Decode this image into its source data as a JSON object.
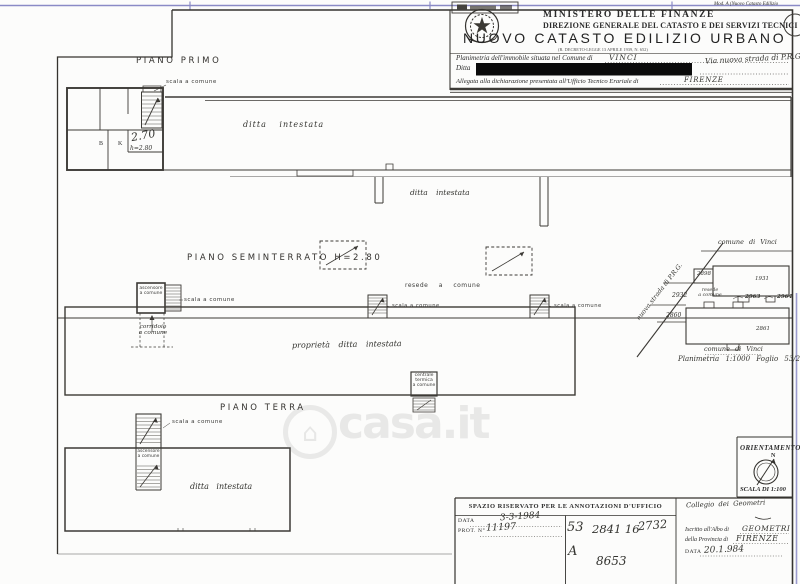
{
  "watermark": {
    "text": "casa.it"
  },
  "header": {
    "mod_label": "Mod. A (Nuovo Catasto Edilizio",
    "ministry": "MINISTERO DELLE FINANZE",
    "direzione": "DIREZIONE GENERALE DEL CATASTO E DEI SERVIZI TECNICI ERARIALI",
    "title": "NUOVO CATASTO EDILIZIO URBANO",
    "decree": "(R. DECRETO-LEGGE 13 APRILE 1939, N. 652)",
    "line1_label": "Planimetria dell'immobile situata nel Comune di",
    "line1_value": "VINCI",
    "line1_right": "Via nuova strada di P.R.G.",
    "ditta_label": "Ditta",
    "line3_label": "Allegata alla dichiarazione presentata all'Ufficio Tecnico Erariale di",
    "line3_value": "FIRENZE"
  },
  "piano_primo": {
    "title": "PIANO PRIMO",
    "scala_label": "scala a comune",
    "room_b": "B",
    "room_k": "K",
    "note_big": "2.70",
    "note_small": "h=2.80",
    "strip_label": "ditta intestata",
    "strip_label2": "ditta intestata"
  },
  "seminterrato": {
    "title": "PIANO SEMINTERRATO H=2.80",
    "ascensore": "ascensore\na comune",
    "scala1": "scala a comune",
    "corridoio": "corridoio\na comune",
    "resede": "resede  a  comune",
    "scala2": "scala a comune",
    "scala3": "scala a comune",
    "proprieta": "proprietà ditta intestata",
    "centrale": "centrale\ntermica\na comune"
  },
  "terra": {
    "title": "PIANO TERRA",
    "scala": "scala a comune",
    "ascensore": "ascensore\na comune",
    "ditta": "ditta intestata"
  },
  "map": {
    "street": "nuova strada di P.R.G.",
    "comune_top": "comune di Vinci",
    "comune_bottom": "comune di Vinci",
    "resede": "resede\na comune",
    "p2898": "2898",
    "p1931": "1931",
    "p2932": "2932",
    "p2963": "2963",
    "p2964": "2964",
    "p2860": "2860",
    "p2861": "2861",
    "caption": "Planimetria 1:1000   Foglio 53/2"
  },
  "orientamento": {
    "title": "ORIENTAMENTO",
    "north": "N",
    "scala": "SCALA DI 1:100"
  },
  "ufficio": {
    "title": "SPAZIO RISERVATO PER LE ANNOTAZIONI D'UFFICIO",
    "data_label": "DATA",
    "data_value": "3-3-1984",
    "prot_label": "PROT. N°",
    "prot_value": "11197",
    "c1": "53",
    "c2": "2841 16",
    "c3": "2732",
    "c4": "A",
    "c5": "8653",
    "firma": "Collegio dei Geometri",
    "albo_label": "Iscritto all'Albo di",
    "albo_value": "GEOMETRI",
    "prov_label": "della Provincia di",
    "prov_value": "FIRENZE",
    "data2_label": "DATA",
    "data2_value": "20.1.984"
  }
}
